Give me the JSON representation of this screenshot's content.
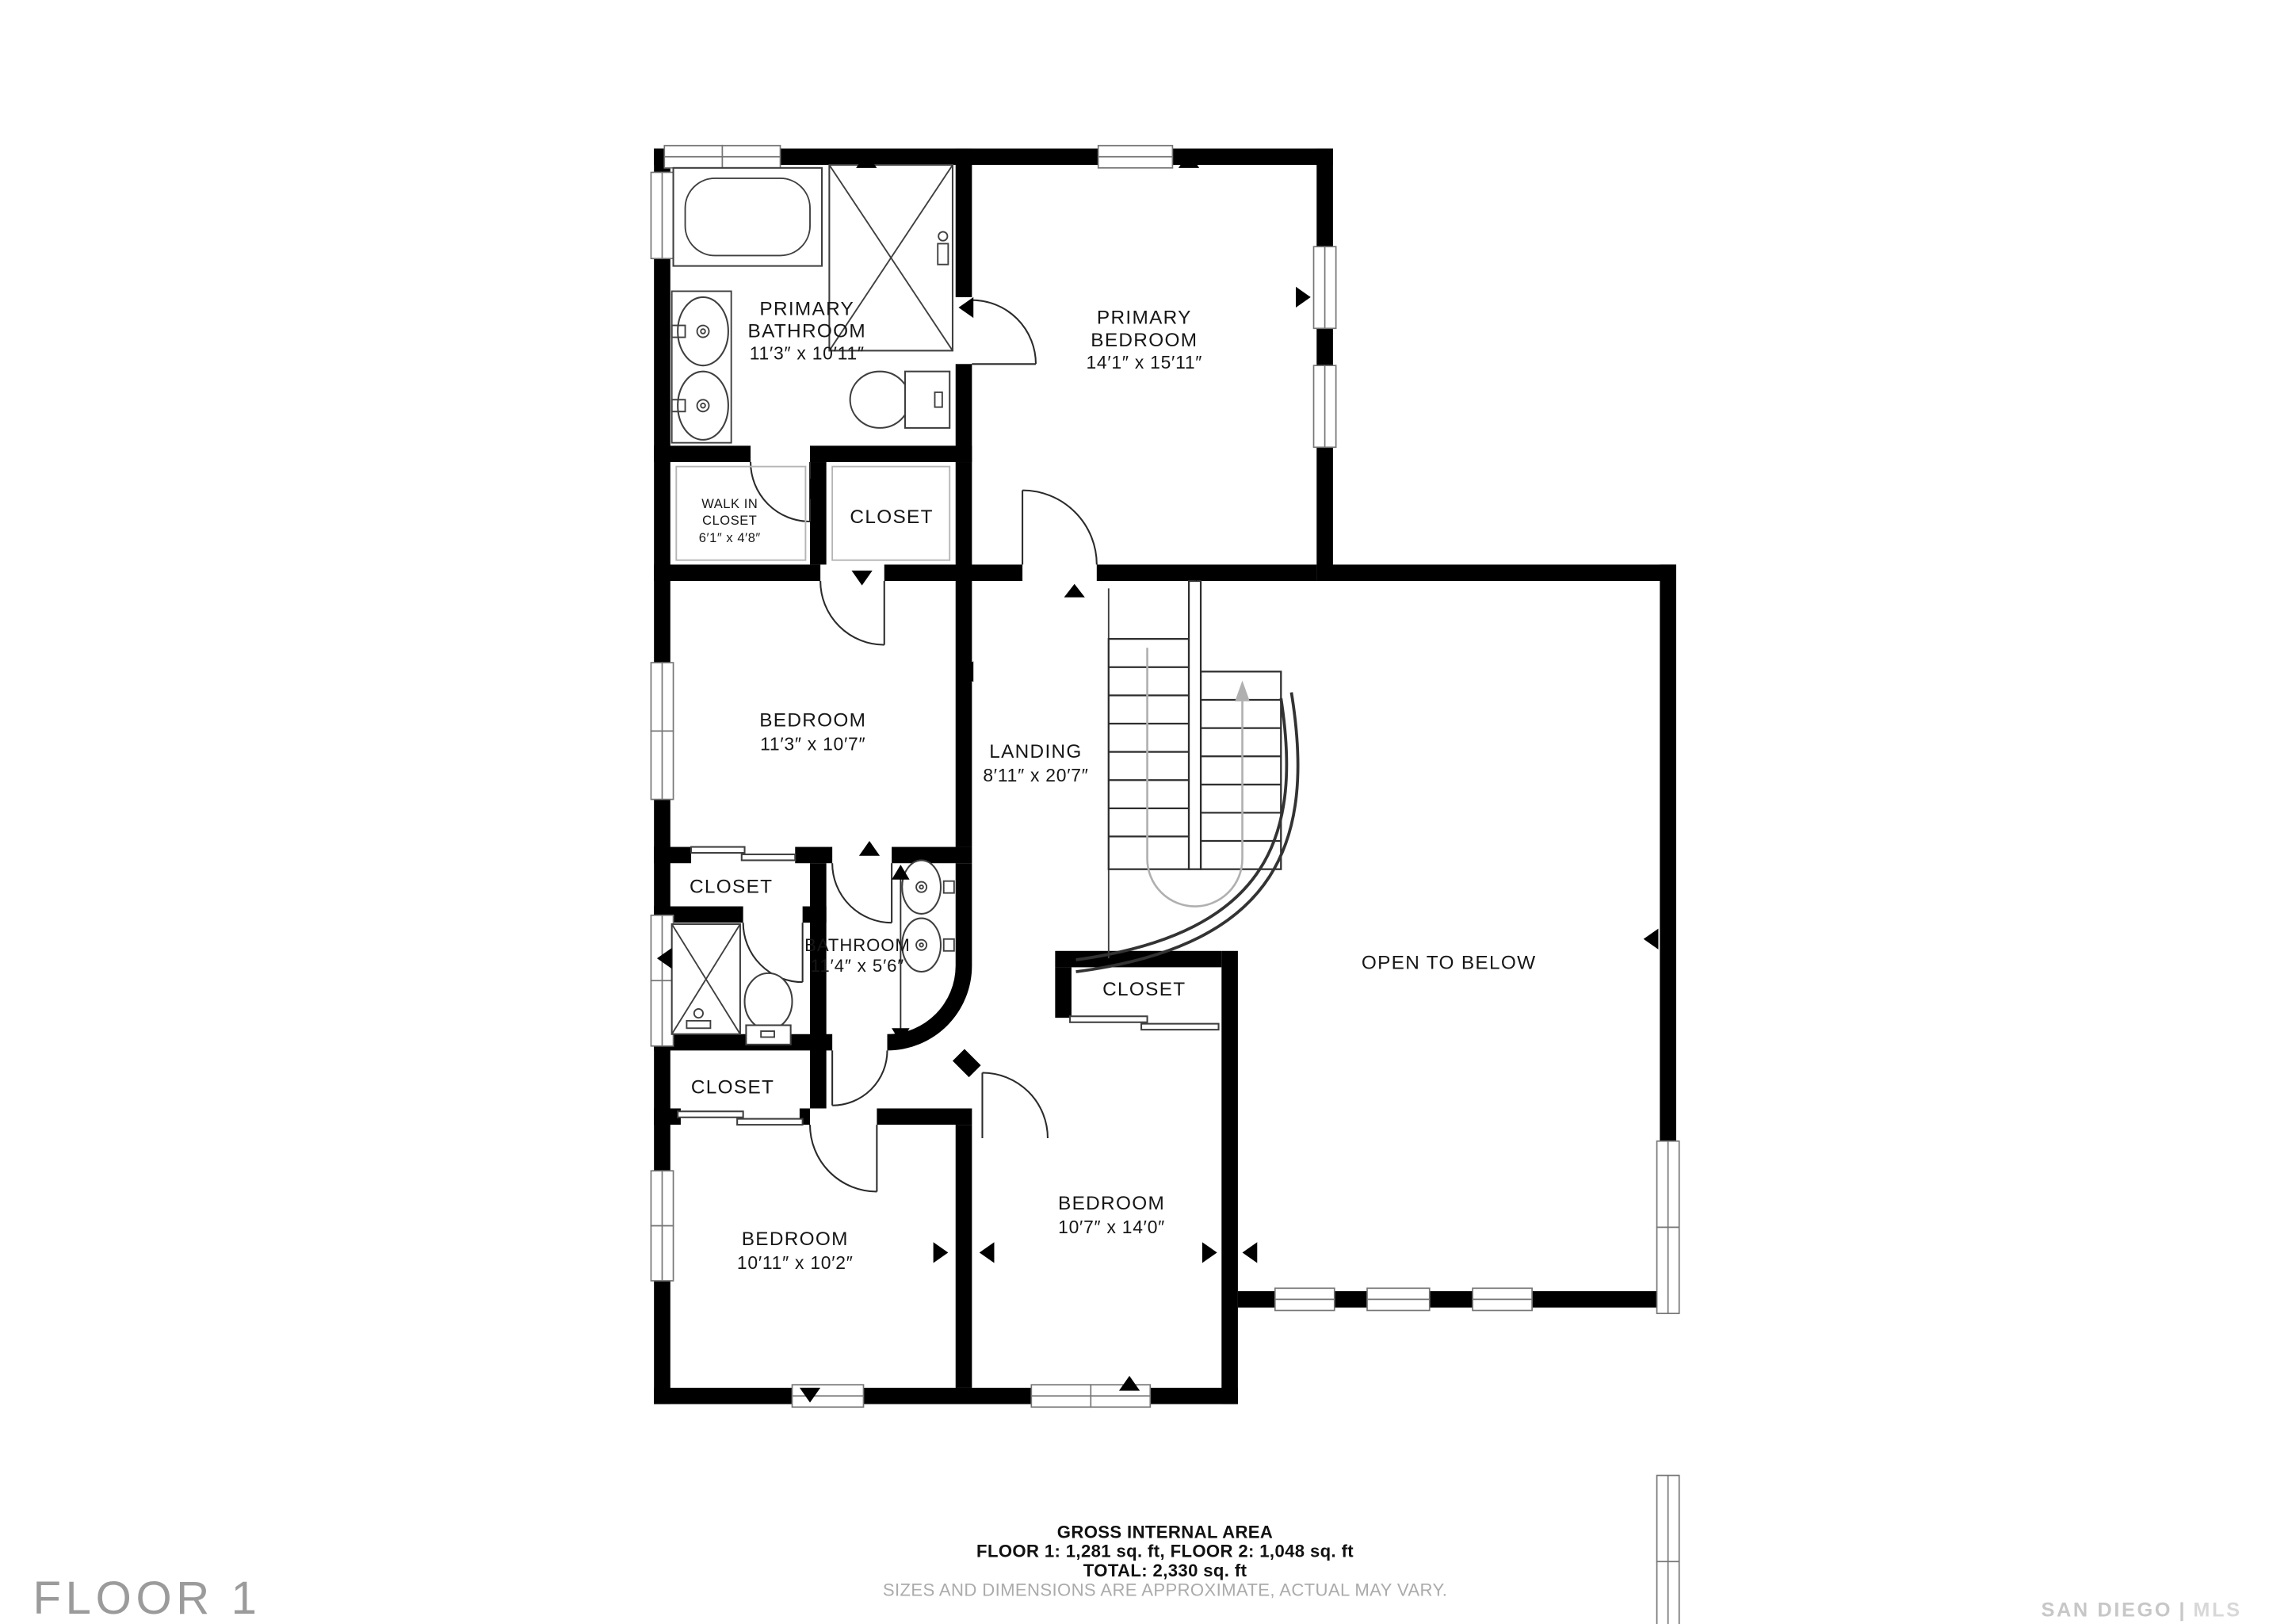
{
  "floor_label": "FLOOR 1",
  "watermark": {
    "left": "SAN DIEGO",
    "divider": "|",
    "right": "MLS"
  },
  "footer": {
    "title": "GROSS INTERNAL AREA",
    "line2": "FLOOR 1: 1,281 sq. ft, FLOOR 2: 1,048 sq. ft",
    "line3": "TOTAL: 2,330 sq. ft",
    "disclaimer": "SIZES AND DIMENSIONS ARE APPROXIMATE, ACTUAL MAY VARY."
  },
  "rooms": {
    "primary_bathroom": {
      "lines": [
        "PRIMARY",
        "BATHROOM",
        "11′3″ x 10′11″"
      ]
    },
    "primary_bedroom": {
      "lines": [
        "PRIMARY",
        "BEDROOM",
        "14′1″ x 15′11″"
      ]
    },
    "walk_in_closet": {
      "lines": [
        "WALK IN",
        "CLOSET",
        "6′1″ x 4′8″"
      ]
    },
    "closet_primary": {
      "label": "CLOSET"
    },
    "bedroom_left": {
      "lines": [
        "BEDROOM",
        "11′3″ x 10′7″"
      ]
    },
    "landing": {
      "lines": [
        "LANDING",
        "8′11″ x 20′7″"
      ]
    },
    "open_to_below": {
      "label": "OPEN TO BELOW"
    },
    "closet_hall": {
      "label": "CLOSET"
    },
    "bathroom": {
      "lines": [
        "BATHROOM",
        "11′4″ x 5′6″"
      ]
    },
    "closet_mid": {
      "label": "CLOSET"
    },
    "closet_lower": {
      "label": "CLOSET"
    },
    "bedroom_bottom_left": {
      "lines": [
        "BEDROOM",
        "10′11″ x 10′2″"
      ]
    },
    "bedroom_bottom_mid": {
      "lines": [
        "BEDROOM",
        "10′7″ x 14′0″"
      ]
    }
  },
  "colors": {
    "wall": "#000000",
    "label": "#161616",
    "window_frame": "#767676",
    "fixture_stroke": "#3f3f3f",
    "stair_route": "#b0b0b0",
    "disclaimer_text": "#ababab",
    "floor_label_text": "#9b9b9b",
    "watermark_text": "#c7c7c7",
    "background": "#ffffff"
  }
}
